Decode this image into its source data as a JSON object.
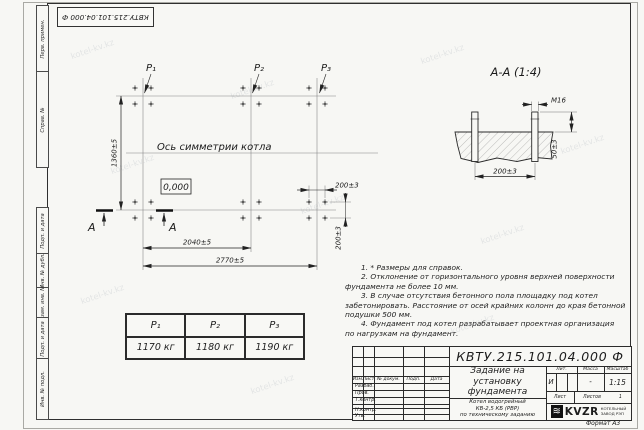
{
  "watermark": "kotel-kv.kz",
  "margin_labels": {
    "top": [
      "Перв. примен.",
      "Справ. №"
    ],
    "bottom": [
      "Подп. и дата",
      "Инв. № дубл.",
      "Взам. инв. №",
      "Подп. и дата",
      "Инв. № подл."
    ]
  },
  "plan": {
    "point_labels": [
      "P₁",
      "P₂",
      "P₃"
    ],
    "axis_label": "Ось симметрии котла",
    "elevation_mark": "0,000",
    "section_letter": "А",
    "dim_height": "1360±5",
    "dim_width_inner": "2040±5",
    "dim_width_total": "2770±5",
    "dim_bolt_h": "200±3",
    "dim_bolt_v": "200±3"
  },
  "section_view": {
    "title": "А-А (1:4)",
    "dim_thread": "М16",
    "dim_protrusion": "50±3",
    "dim_spacing": "200±3"
  },
  "load_table": {
    "headers": [
      "P₁",
      "P₂",
      "P₃"
    ],
    "values": [
      "1170 кг",
      "1180 кг",
      "1190 кг"
    ]
  },
  "notes": {
    "lines": [
      "1. * Размеры для справок.",
      "2. Отклонение от горизонтального уровня верхней поверхности",
      "фундамента не более 10 мм.",
      "3. В случае отсутствия бетонного пола площадку под котел",
      "забетонировать. Расстояние от осей крайних колонн до края бетонной",
      "подушки 500 мм.",
      "4. Фундамент под котел разрабатывает проектная организация",
      "по нагрузкам на фундамент."
    ]
  },
  "title_block": {
    "doc_number": "КВТУ.215.101.04.000 Ф",
    "doc_title": [
      "Задание на",
      "установку",
      "фундамента"
    ],
    "product": [
      "Котел водогрейный",
      "КВ-2,5 КБ (РВР)",
      "по техническому заданию"
    ],
    "change_header": [
      "Изм.",
      "Лист",
      "№ докум.",
      "Подп.",
      "Дата"
    ],
    "role_rows": [
      "Разраб.",
      "Пров.",
      "Т.контр.",
      "Н.контр.",
      "Утв."
    ],
    "lit_label": "Лит.",
    "mass_label": "Масса",
    "scale_label": "Масштаб",
    "lit_value": "И",
    "mass_value": "-",
    "scale_value": "1:15",
    "sheet_label": "Лист",
    "sheets_label": "Листов",
    "sheets_value": "1",
    "logo_text": "KVZR",
    "logo_caption": [
      "КОТЕЛЬНЫЙ",
      "ЗАВОД РЭП"
    ],
    "format_note": "Формат А3"
  }
}
